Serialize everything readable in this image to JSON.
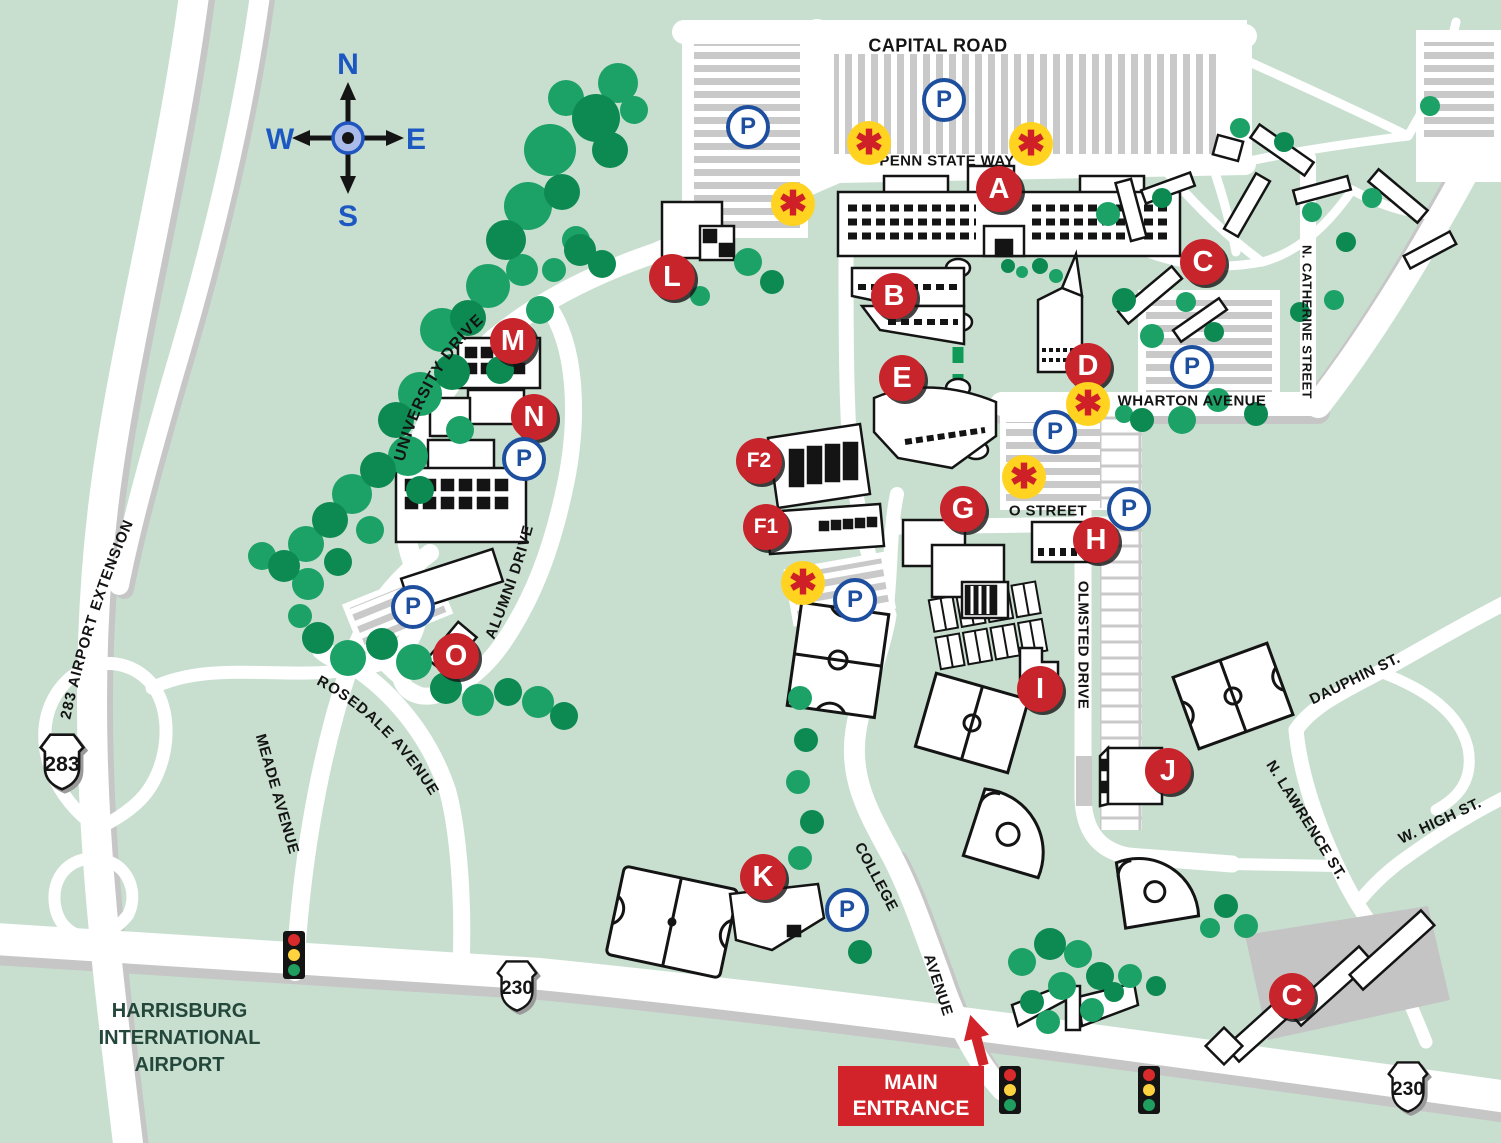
{
  "map": {
    "region_labels": {
      "airport": [
        "HARRISBURG",
        "INTERNATIONAL",
        "AIRPORT"
      ],
      "main_entrance": [
        "MAIN",
        "ENTRANCE"
      ]
    },
    "compass": {
      "north": "N",
      "south": "S",
      "east": "E",
      "west": "W"
    },
    "streets": [
      {
        "name": "CAPITAL ROAD",
        "x": 938,
        "y": 46,
        "rot": 0,
        "size": 18
      },
      {
        "name": "PENN STATE WAY",
        "x": 947,
        "y": 161,
        "rot": 0,
        "size": 15
      },
      {
        "name": "WHARTON AVENUE",
        "x": 1192,
        "y": 401,
        "rot": 0,
        "size": 15
      },
      {
        "name": "O STREET",
        "x": 1048,
        "y": 511,
        "rot": 0,
        "size": 15
      },
      {
        "name": "OLMSTED DRIVE",
        "x": 1083,
        "y": 645,
        "rot": 90,
        "size": 15
      },
      {
        "name": "N. CATHERINE STREET",
        "x": 1307,
        "y": 322,
        "rot": 90,
        "size": 13
      },
      {
        "name": "DAUPHIN ST.",
        "x": 1355,
        "y": 679,
        "rot": -26,
        "size": 15
      },
      {
        "name": "N. LAWRENCE ST.",
        "x": 1306,
        "y": 820,
        "rot": 58,
        "size": 15
      },
      {
        "name": "W. HIGH ST.",
        "x": 1440,
        "y": 821,
        "rot": -25,
        "size": 15
      },
      {
        "name": "MEADE AVENUE",
        "x": 277,
        "y": 794,
        "rot": 74,
        "size": 15
      },
      {
        "name": "COLLEGE",
        "x": 876,
        "y": 877,
        "rot": 62,
        "size": 15
      },
      {
        "name": "AVENUE",
        "x": 938,
        "y": 985,
        "rot": 72,
        "size": 15
      }
    ],
    "curved_streets": {
      "university_drive": "UNIVERSITY DRIVE",
      "alumni_drive": "ALUMNI DRIVE",
      "rosedale_avenue": "ROSEDALE AVENUE",
      "airport_extension": "283 AIRPORT EXTENSION"
    },
    "building_markers": [
      {
        "id": "A",
        "x": 999,
        "y": 189
      },
      {
        "id": "B",
        "x": 894,
        "y": 296
      },
      {
        "id": "C",
        "x": 1203,
        "y": 262
      },
      {
        "id": "C",
        "x": 1292,
        "y": 996
      },
      {
        "id": "D",
        "x": 1088,
        "y": 366
      },
      {
        "id": "E",
        "x": 902,
        "y": 378
      },
      {
        "id": "F2",
        "x": 759,
        "y": 461
      },
      {
        "id": "F1",
        "x": 766,
        "y": 527
      },
      {
        "id": "G",
        "x": 963,
        "y": 509
      },
      {
        "id": "H",
        "x": 1096,
        "y": 540
      },
      {
        "id": "I",
        "x": 1040,
        "y": 689
      },
      {
        "id": "J",
        "x": 1168,
        "y": 771
      },
      {
        "id": "K",
        "x": 763,
        "y": 877
      },
      {
        "id": "L",
        "x": 672,
        "y": 277
      },
      {
        "id": "M",
        "x": 513,
        "y": 341
      },
      {
        "id": "N",
        "x": 534,
        "y": 417
      },
      {
        "id": "O",
        "x": 456,
        "y": 656
      }
    ],
    "parking_symbol": "P",
    "parking_locations": [
      {
        "x": 748,
        "y": 127
      },
      {
        "x": 944,
        "y": 100
      },
      {
        "x": 1192,
        "y": 367
      },
      {
        "x": 1055,
        "y": 432
      },
      {
        "x": 1129,
        "y": 509
      },
      {
        "x": 855,
        "y": 600
      },
      {
        "x": 524,
        "y": 459
      },
      {
        "x": 413,
        "y": 607
      },
      {
        "x": 847,
        "y": 910
      }
    ],
    "emergency_symbol": "✱",
    "emergency_locations": [
      {
        "x": 869,
        "y": 143
      },
      {
        "x": 1031,
        "y": 144
      },
      {
        "x": 793,
        "y": 204
      },
      {
        "x": 1088,
        "y": 404
      },
      {
        "x": 1024,
        "y": 477
      },
      {
        "x": 803,
        "y": 583
      }
    ],
    "route_shields": [
      {
        "route": "283",
        "x": 62,
        "y": 765,
        "size": 62
      },
      {
        "route": "230",
        "x": 517,
        "y": 989,
        "size": 56
      },
      {
        "route": "230",
        "x": 1408,
        "y": 1090,
        "size": 56
      }
    ],
    "traffic_light_locations": [
      {
        "x": 294,
        "y": 955
      },
      {
        "x": 1010,
        "y": 1090
      },
      {
        "x": 1149,
        "y": 1090
      }
    ],
    "colors": {
      "background": "#c8dfd0",
      "road_white": "#ffffff",
      "road_shadow": "#c6c6c6",
      "parking_stripe": "#c9c9c9",
      "tree_green": "#1ca167",
      "tree_green_dark": "#0d8a52",
      "building_outline": "#141414",
      "marker_red": "#c8242b",
      "parking_blue": "#1d4f9e",
      "phone_yellow": "#ffd320",
      "phone_red": "#cf2027",
      "walkway_green": "#109a58",
      "entrance_red": "#d2232a",
      "compass_blue": "#1d58c2",
      "airport_text": "#24473c"
    }
  }
}
